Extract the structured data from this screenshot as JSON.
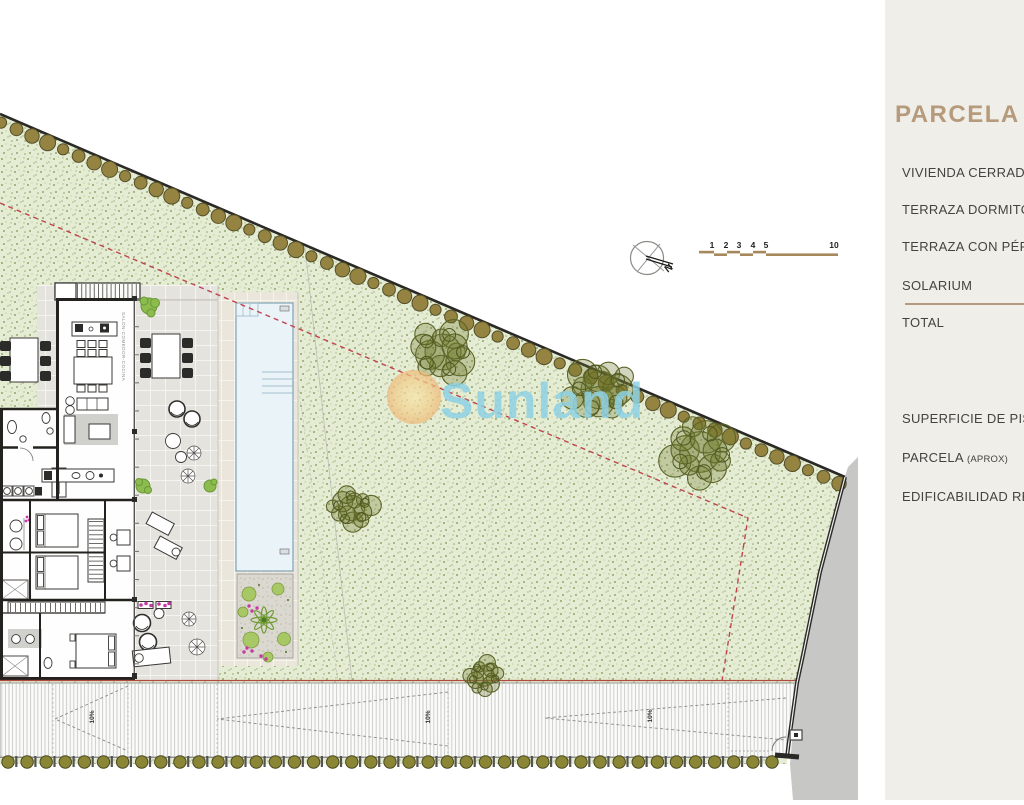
{
  "sidebar": {
    "title": "PARCELA",
    "rows": [
      {
        "label": "VIVIENDA CERRAD"
      },
      {
        "label": "TERRAZA DORMITO"
      },
      {
        "label": "TERRAZA CON PÉR"
      },
      {
        "label": "SOLARIUM"
      }
    ],
    "total_label": "TOTAL",
    "rows2": [
      {
        "label": "SUPERFICIE DE PIS"
      },
      {
        "label": "PARCELA",
        "suffix": "(APROX)"
      },
      {
        "label": "EDIFICABILIDAD RE"
      }
    ]
  },
  "plan": {
    "watermark": "Sunland",
    "north_label": "N",
    "scale_ticks": [
      "1",
      "2",
      "3",
      "4",
      "5",
      "10"
    ],
    "slope_labels": [
      "10%",
      "10%",
      "10%"
    ],
    "room_label": "SALÓN-COMEDOR-COCINA"
  },
  "colors": {
    "sidebar_bg": "#f0eee8",
    "accent_tan": "#b69a7c",
    "text_dark": "#454340",
    "parcel_green": "#e4ecd3",
    "pool_blue": "#e9f3f8",
    "watermark_blue": "#8ed2e4",
    "setback_red": "#c0444d",
    "tree_olive": "#958441",
    "gray_zone": "#c7c7c6",
    "scale_bar_tan": "#a5885c"
  }
}
